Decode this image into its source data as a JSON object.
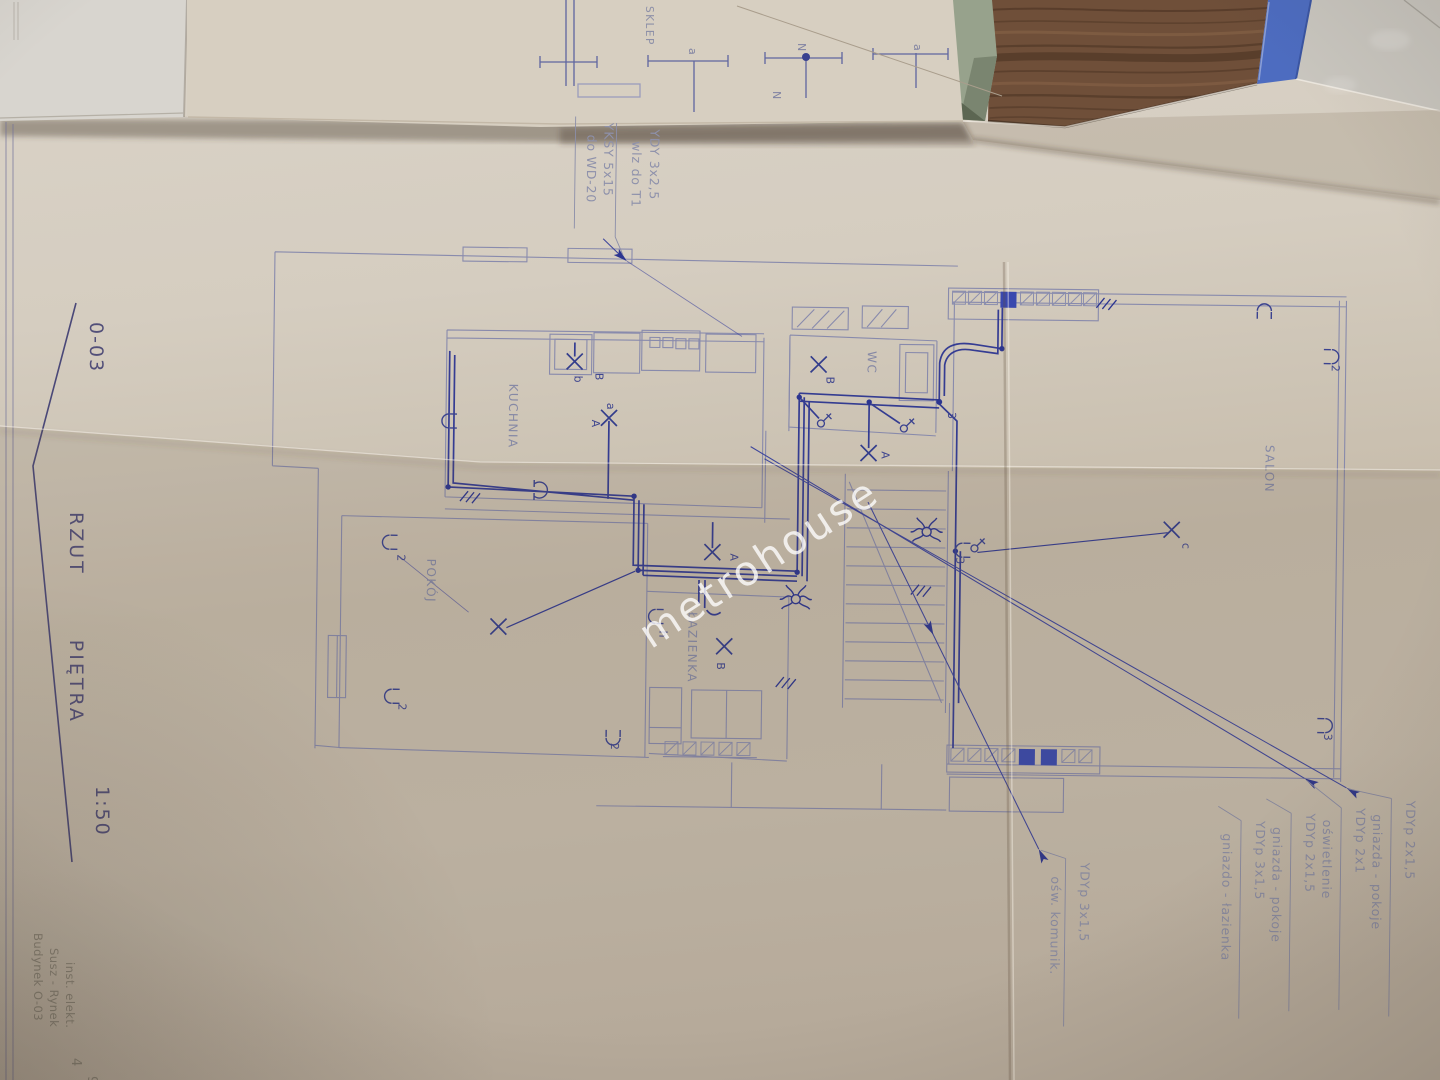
{
  "watermark": "metrohouse",
  "colors": {
    "radiator_blue": "#3a49ae",
    "ink_blue": "#2c3590",
    "print_blue": "#8184ab",
    "paper": "#cfc6b7",
    "wood": "#6f4f39",
    "folder_green": "#97a28c",
    "strip_blue": "#4d6cc0"
  },
  "sheet": {
    "code": "0-03",
    "title": "RZUT PIĘTRA",
    "scale": "1:50"
  },
  "rooms": {
    "kuchnia": "KUCHNIA",
    "pokoj": "POKÓJ",
    "lazienka": "ŁAZIENKA",
    "wc": "WC",
    "salon": "SALON",
    "sklep": "SKLEP"
  },
  "callouts": {
    "top": {
      "cable1": "YDY 3x2,5",
      "dest1": "wlz do T1",
      "cable2": "YKSY 5x15",
      "dest2": "do WD-20"
    },
    "right": [
      {
        "cable": "YDYp 2x1,5",
        "desc": "gniazda - pokoje"
      },
      {
        "cable": "YDYp 2x1",
        "desc": "oświetlenie"
      },
      {
        "cable": "YDYp 2x1,5",
        "desc": "gniazda - pokoje"
      },
      {
        "cable": "YDYp 3x1,5",
        "desc": "gniazdo - łazienka"
      }
    ],
    "bottom": {
      "cable": "YDYp 3x1,5",
      "desc": "ośw. komunik."
    }
  },
  "corner_note": {
    "line1": "Budynek O-03",
    "line2": "Susz - Rynek",
    "line3": "inst. elekt.",
    "num1": "4",
    "num2": "9"
  },
  "marks": [
    {
      "t": "A"
    },
    {
      "t": "a"
    },
    {
      "t": "B"
    },
    {
      "t": "b"
    },
    {
      "t": "A"
    },
    {
      "t": "B"
    },
    {
      "t": "A"
    },
    {
      "t": "B"
    },
    {
      "t": "h"
    },
    {
      "t": "c"
    },
    {
      "t": "2"
    },
    {
      "t": "2"
    },
    {
      "t": "2"
    },
    {
      "t": "2"
    },
    {
      "t": "3"
    },
    {
      "t": "3"
    },
    {
      "t": "3"
    },
    {
      "t": "a"
    },
    {
      "t": "N"
    },
    {
      "t": "N"
    },
    {
      "t": "a"
    }
  ]
}
